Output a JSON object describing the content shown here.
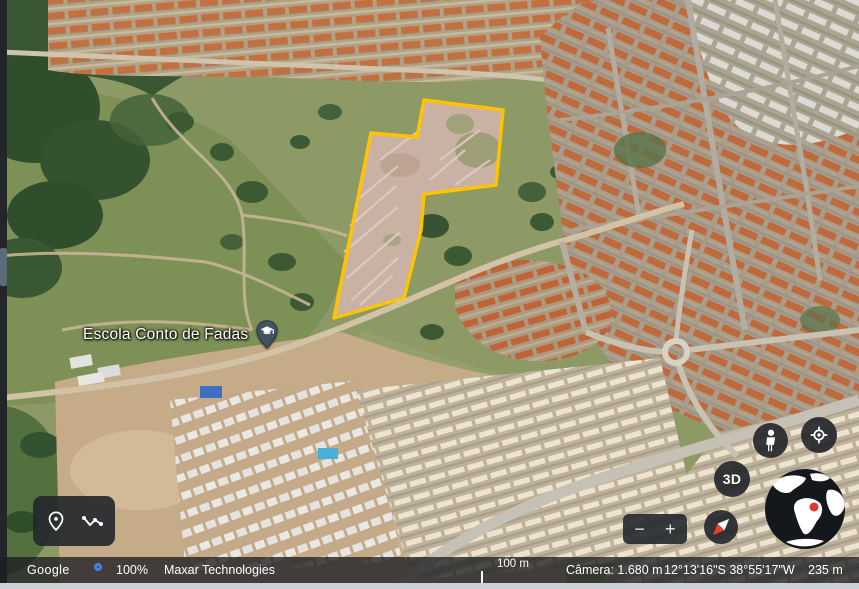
{
  "map": {
    "place_label": "Escola Conto de Fadas",
    "polygon_points": "371,133 417,137 424,100 503,110 496,185 424,194 421,230 404,298 334,318",
    "polygon_color": "#FFC400"
  },
  "controls": {
    "zoom_out": "−",
    "zoom_in": "+",
    "view_3d": "3D",
    "icons": {
      "toolbar_left": "placemark-pin-icon",
      "toolbar_right": "measure-path-icon",
      "pegman": "pegman-person-icon",
      "my_location": "target-icon",
      "compass": "compass-needle-icon",
      "globe": "earth-globe-icon",
      "place_marker": "school-pin-icon"
    }
  },
  "statusbar": {
    "brand": "Google",
    "loading_percent": "100%",
    "imagery_credit": "Maxar Technologies",
    "scale_label": "100 m",
    "camera_altitude": "Câmera: 1.680 m",
    "coordinates": "12°13'16\"S 38°55'17\"W",
    "elevation": "235 m",
    "loading_color": "#4880e8"
  }
}
